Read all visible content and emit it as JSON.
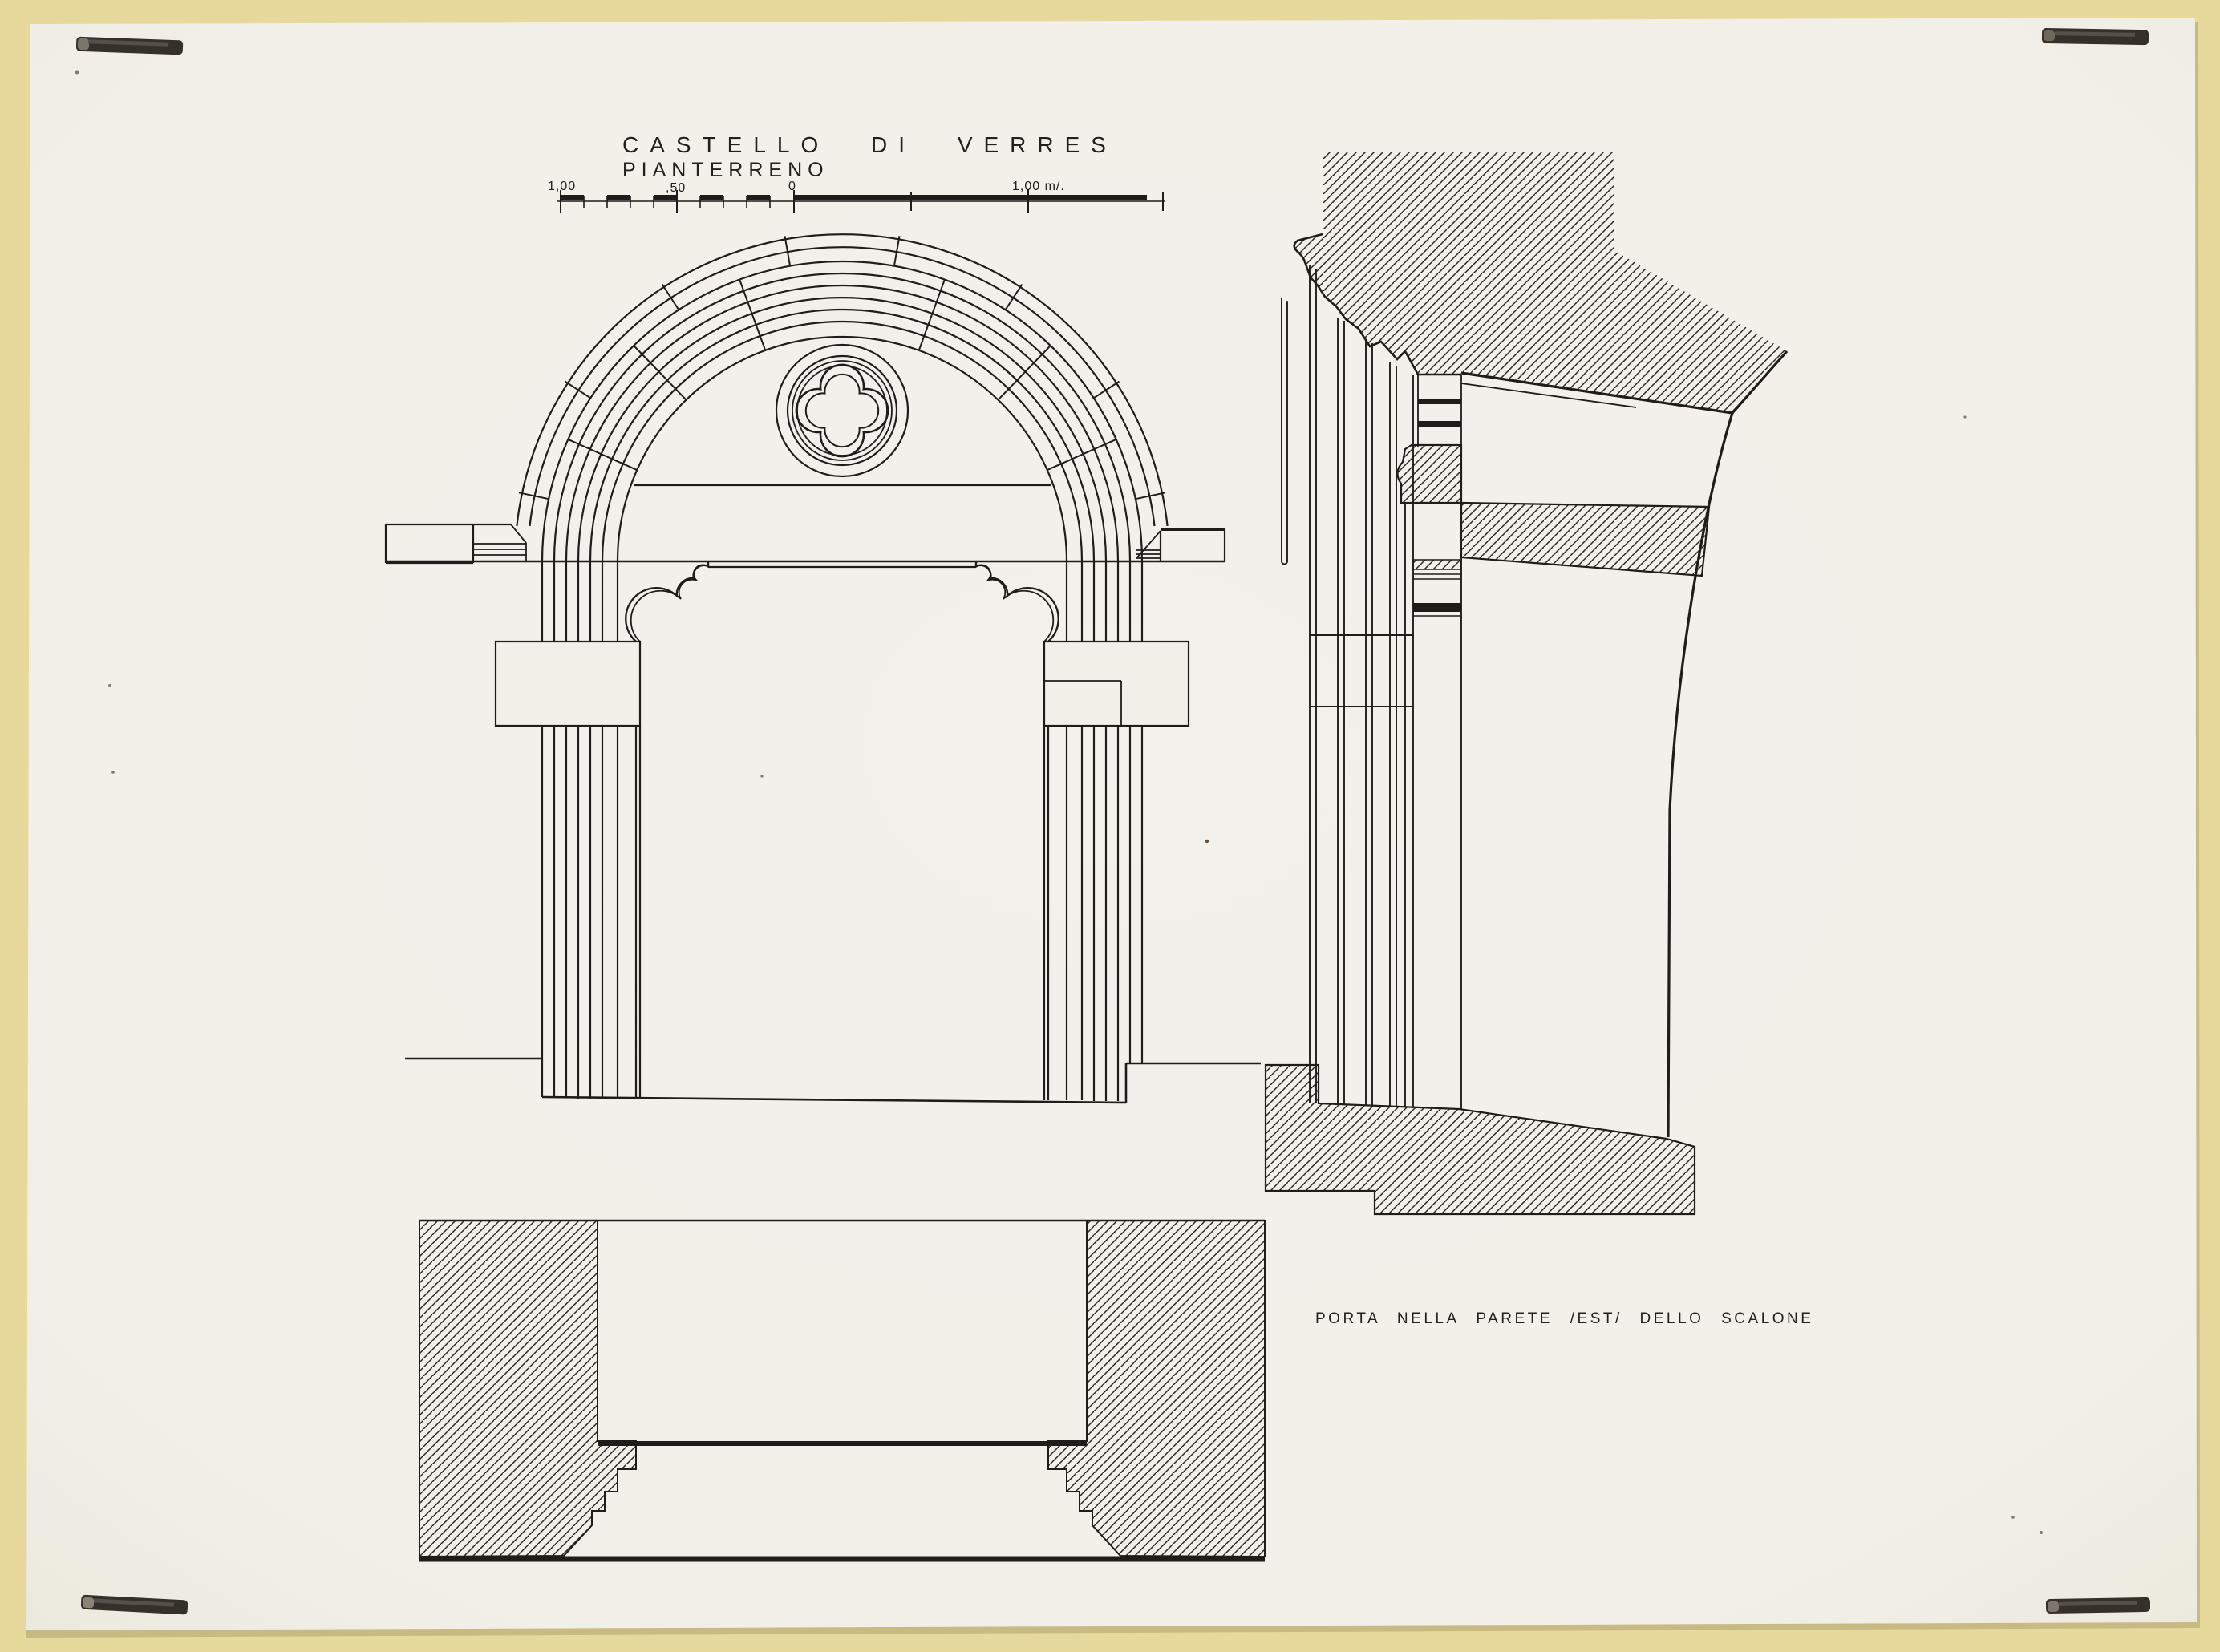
{
  "artwork": {
    "title": "CASTELLO DI VERRES",
    "subtitle": "PIANTERRENO",
    "caption": "PORTA NELLA PARETE /EST/ DELLO SCALONE",
    "scale_bar": {
      "labels": [
        "1,00",
        ",50",
        "0",
        "1,00 m/."
      ]
    },
    "colors": {
      "mat": "#e6d99b",
      "paper": "#f2f0ea",
      "ink": "#1f1d1a",
      "staple": "#35302a"
    }
  }
}
